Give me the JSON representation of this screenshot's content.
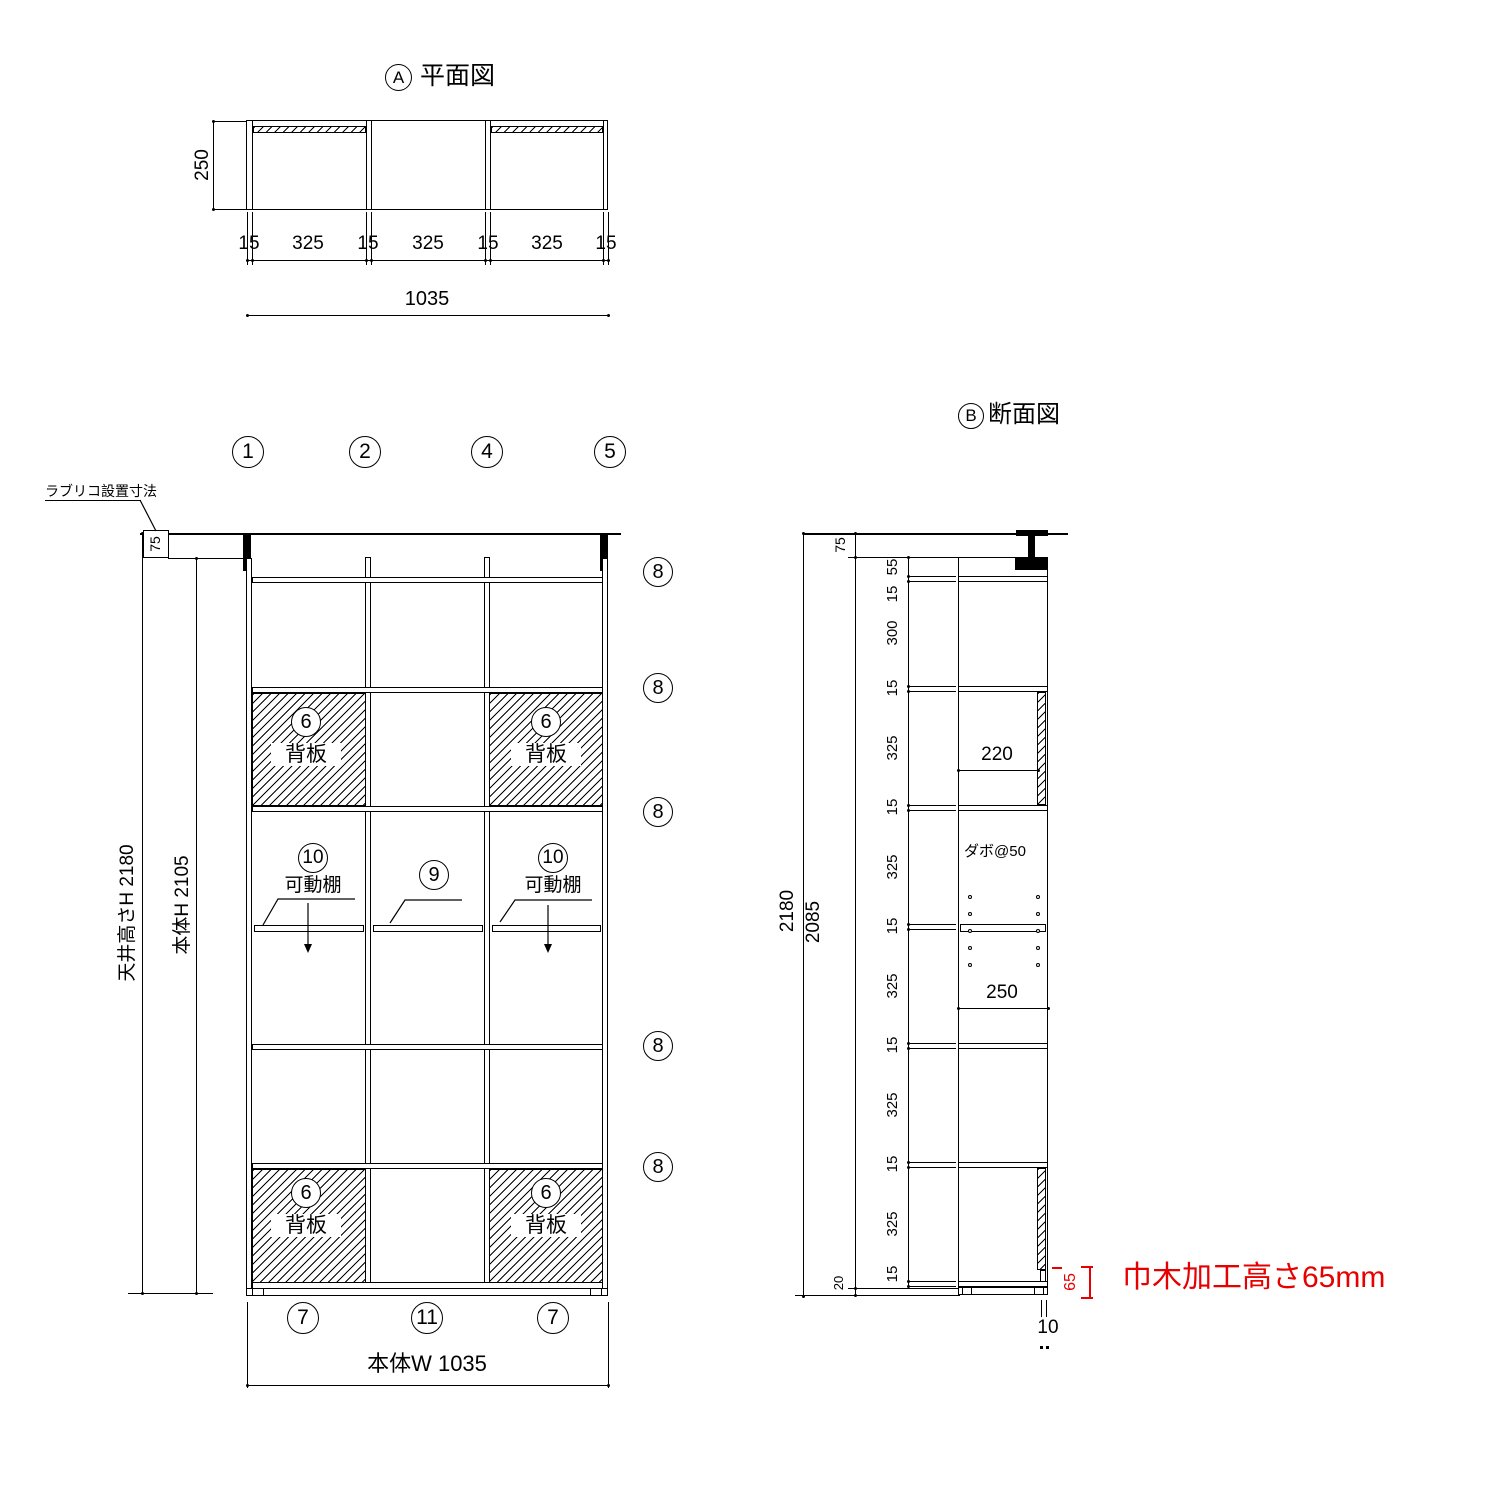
{
  "plan": {
    "marker": "A",
    "title": "平面図",
    "depth_dim": "250",
    "chain": [
      "15",
      "325",
      "15",
      "325",
      "15",
      "325",
      "15"
    ],
    "overall_dim": "1035"
  },
  "elevation": {
    "panel_markers": [
      "1",
      "2",
      "4",
      "5"
    ],
    "shelf_marker": "8",
    "leader_note": "ラブリコ設置寸法",
    "gap_dim": "75",
    "ceiling_dim_label": "天井高さH 2180",
    "body_dim_label": "本体H 2105",
    "back_panel": {
      "marker": "6",
      "label": "背板"
    },
    "movable": {
      "marker": "10",
      "label": "可動棚"
    },
    "middle_shelf_marker": "9",
    "bottom_markers": [
      "7",
      "11",
      "7"
    ],
    "width_dim_label": "本体W 1035"
  },
  "section": {
    "marker": "B",
    "title": "断面図",
    "overall_dim": "2180",
    "body_dim": "2085",
    "gap_dim": "75",
    "base_dim": "20",
    "chain": [
      "55",
      "15",
      "300",
      "15",
      "325",
      "15",
      "325",
      "15",
      "325",
      "15",
      "325",
      "15",
      "325",
      "15"
    ],
    "upper_depth_dim": "220",
    "shelf_depth_dim": "250",
    "dowel_note": "ダボ@50",
    "back_gap_dim": "10",
    "notch_dim": "65",
    "notch_note": "巾木加工高さ65mm"
  },
  "colors": {
    "accent": "#e60000",
    "line": "#000000"
  }
}
